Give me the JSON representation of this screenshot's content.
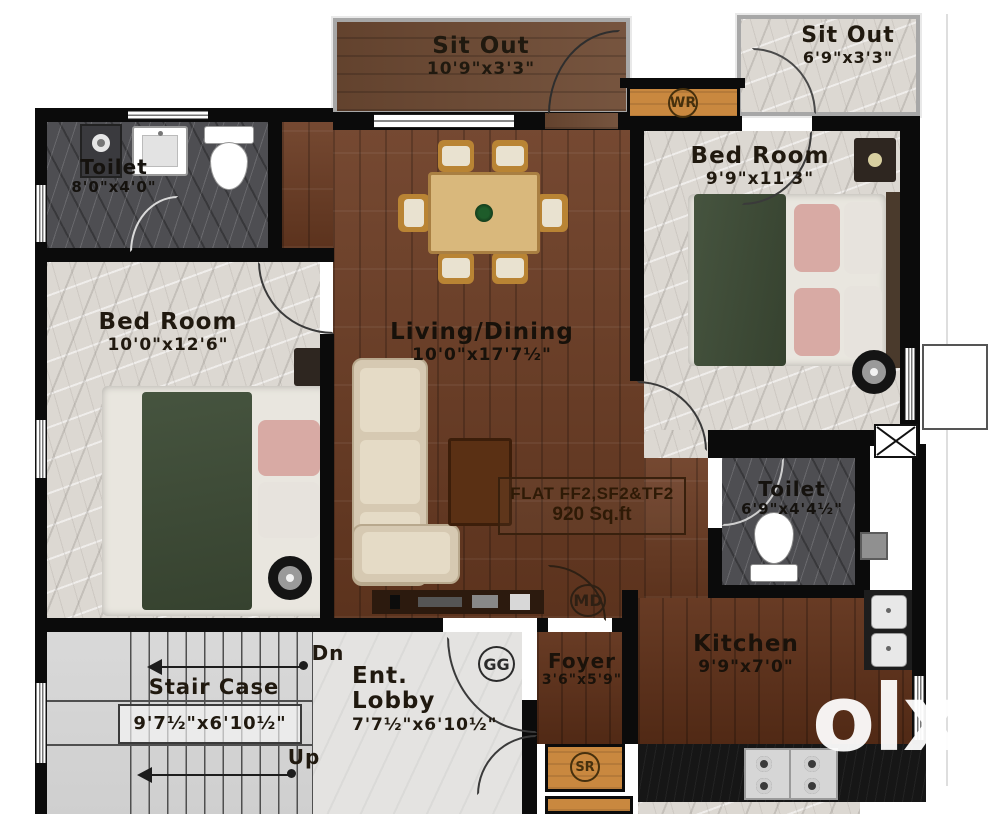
{
  "rooms": {
    "sit_out_top": {
      "name": "Sit Out",
      "dims": "10'9\"x3'3\""
    },
    "sit_out_right": {
      "name": "Sit Out",
      "dims": "6'9\"x3'3\""
    },
    "toilet_top": {
      "name": "Toilet",
      "dims": "8'0\"x4'0\""
    },
    "bedroom_right": {
      "name": "Bed Room",
      "dims": "9'9\"x11'3\""
    },
    "bedroom_left": {
      "name": "Bed Room",
      "dims": "10'0\"x12'6\""
    },
    "living_dining": {
      "name": "Living/Dining",
      "dims": "10'0\"x17'7½\""
    },
    "toilet_right": {
      "name": "Toilet",
      "dims": "6'9\"x4'4½\""
    },
    "kitchen": {
      "name": "Kitchen",
      "dims": "9'9\"x7'0\""
    },
    "foyer": {
      "name": "Foyer",
      "dims": "3'6\"x5'9\""
    },
    "stair_case": {
      "name": "Stair Case",
      "dims": "9'7½\"x6'10½\""
    },
    "ent_lobby": {
      "line1": "Ent.",
      "line2": "Lobby",
      "dims": "7'7½\"x6'10½\""
    }
  },
  "flat_info": {
    "line1": "FLAT FF2,SF2&TF2",
    "line2": "920 Sq.ft"
  },
  "markers": {
    "wr": "WR",
    "md": "MD",
    "gg": "GG",
    "sr": "SR"
  },
  "stairs": {
    "down": "Dn",
    "up": "Up"
  },
  "watermark": {
    "logo": "olx",
    "country": "INDIA"
  },
  "colors": {
    "wall": "#0b0b0b",
    "wood": "#6b3b22",
    "marble_light": "#dcd8d2",
    "marble_dark": "#4e4e52",
    "accent_orange": "#c9883f",
    "stair_gray": "#d6d6d6"
  }
}
